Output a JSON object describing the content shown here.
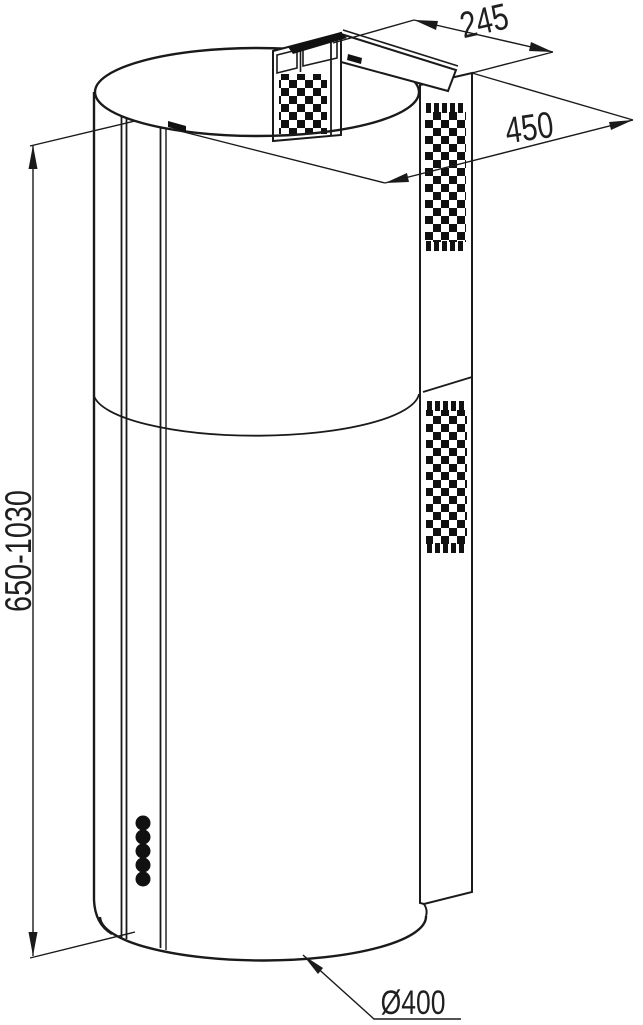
{
  "drawing": {
    "kind": "dimensioned line drawing of a cylindrical island cooker hood",
    "labels": {
      "top_depth": "245",
      "total_depth": "450",
      "height_range": "650-1030",
      "base_diameter": "Ø400"
    },
    "colors": {
      "line": "#1a1a1a",
      "background": "#ffffff"
    }
  }
}
